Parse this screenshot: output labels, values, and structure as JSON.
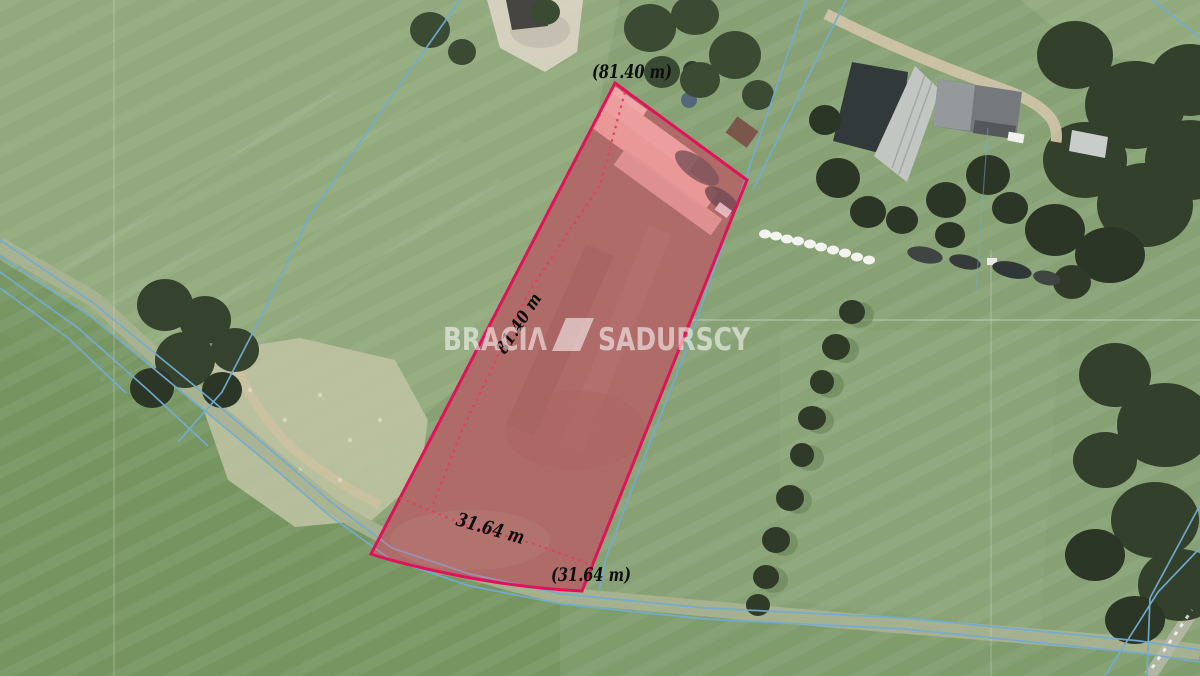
{
  "watermark": {
    "left": "BRACIΛ",
    "right": "SADURSCY",
    "color": "#ffffff"
  },
  "parcel": {
    "outline_color": "#e0125a",
    "fill_color": "#ec5f7d",
    "dotted_color": "#e04258",
    "labels": {
      "top_length": "(81.40 m)",
      "side_length": "81.40 m",
      "bottom_width": "31.64 m",
      "bottom_width_outer": "(31.64 m)"
    }
  },
  "cadastral": {
    "line_color": "#72acd3"
  }
}
